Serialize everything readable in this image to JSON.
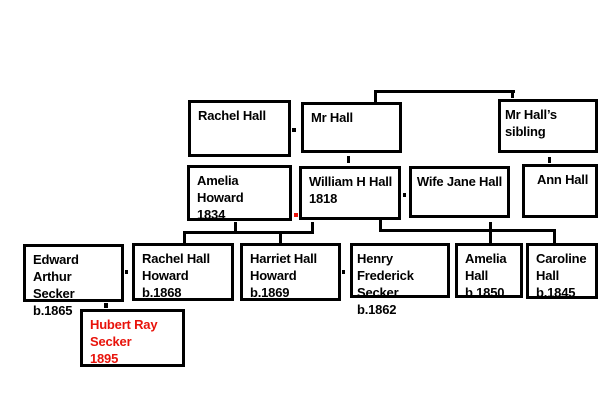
{
  "palette": {
    "background": "#ffffff",
    "box_border": "#000000",
    "text": "#000000",
    "highlight_red": "#e8130b"
  },
  "diagram_title": "Hall family tree",
  "boxes": {
    "rachel_hall": {
      "text": "Rachel Hall"
    },
    "mr_hall": {
      "text": "Mr Hall"
    },
    "mr_halls_sibling": {
      "text": "Mr Hall’s sibling"
    },
    "amelia_howard": {
      "text": "Amelia Howard\n1834"
    },
    "william_h_hall": {
      "text": "William H Hall\n1818"
    },
    "wife_jane_hall": {
      "text": "Wife Jane Hall"
    },
    "ann_hall": {
      "text": "Ann Hall"
    },
    "edward_arthur_secker": {
      "text": "Edward Arthur\nSecker\nb.1865"
    },
    "rachel_hall_howard": {
      "text": "Rachel Hall\nHoward\nb.1868"
    },
    "harriet_hall_howard": {
      "text": "Harriet Hall\nHoward\nb.1869"
    },
    "henry_frederick_secker": {
      "text": "Henry Frederick\nSecker\nb.1862"
    },
    "amelia_hall": {
      "text": "Amelia\nHall\nb.1850"
    },
    "caroline_hall": {
      "text": "Caroline\nHall\nb.1845"
    },
    "hubert_ray_secker": {
      "text": "Hubert Ray\nSecker\n 1895",
      "color": "#e8130b"
    }
  }
}
